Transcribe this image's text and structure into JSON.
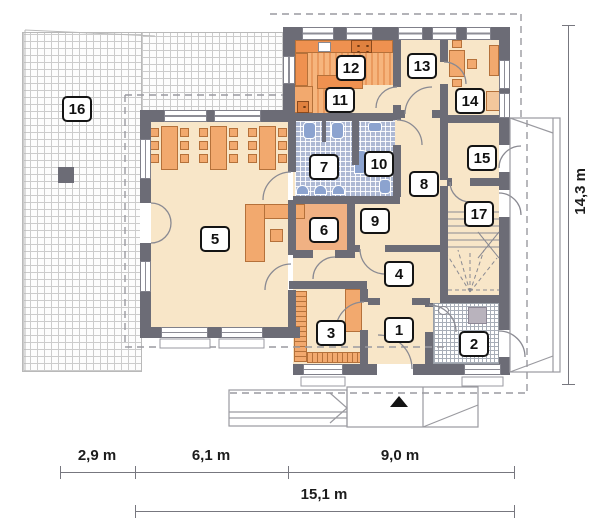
{
  "plan_title": "first floor plan",
  "rooms": [
    {
      "number": "1"
    },
    {
      "number": "2"
    },
    {
      "number": "3"
    },
    {
      "number": "4"
    },
    {
      "number": "5"
    },
    {
      "number": "6"
    },
    {
      "number": "7"
    },
    {
      "number": "8"
    },
    {
      "number": "9"
    },
    {
      "number": "10"
    },
    {
      "number": "11"
    },
    {
      "number": "12"
    },
    {
      "number": "13"
    },
    {
      "number": "14"
    },
    {
      "number": "15"
    },
    {
      "number": "16"
    },
    {
      "number": "17"
    }
  ],
  "dimensions": {
    "bottom": {
      "segments": [
        {
          "label": "2,9 m"
        },
        {
          "label": "6,1 m"
        },
        {
          "label": "9,0 m"
        }
      ],
      "total": {
        "label": "15,1 m"
      }
    },
    "right": {
      "total": {
        "label": "14,3 m"
      }
    }
  },
  "icons": {
    "entrance_marker": "filled-triangle-up",
    "ramp_arrow": "chevron-right"
  },
  "colors": {
    "wall": "#6c6c76",
    "floor": "#f8e6c8",
    "furniture_fill": "#f2a96e",
    "furniture_border": "#b5713a",
    "kitchen_counter": "#ef9150",
    "bath_tile": "#aeb9d4",
    "fixture_blue": "#8ca3cf",
    "terrace_line": "#cccccc",
    "dash": "#9a9aa0"
  }
}
